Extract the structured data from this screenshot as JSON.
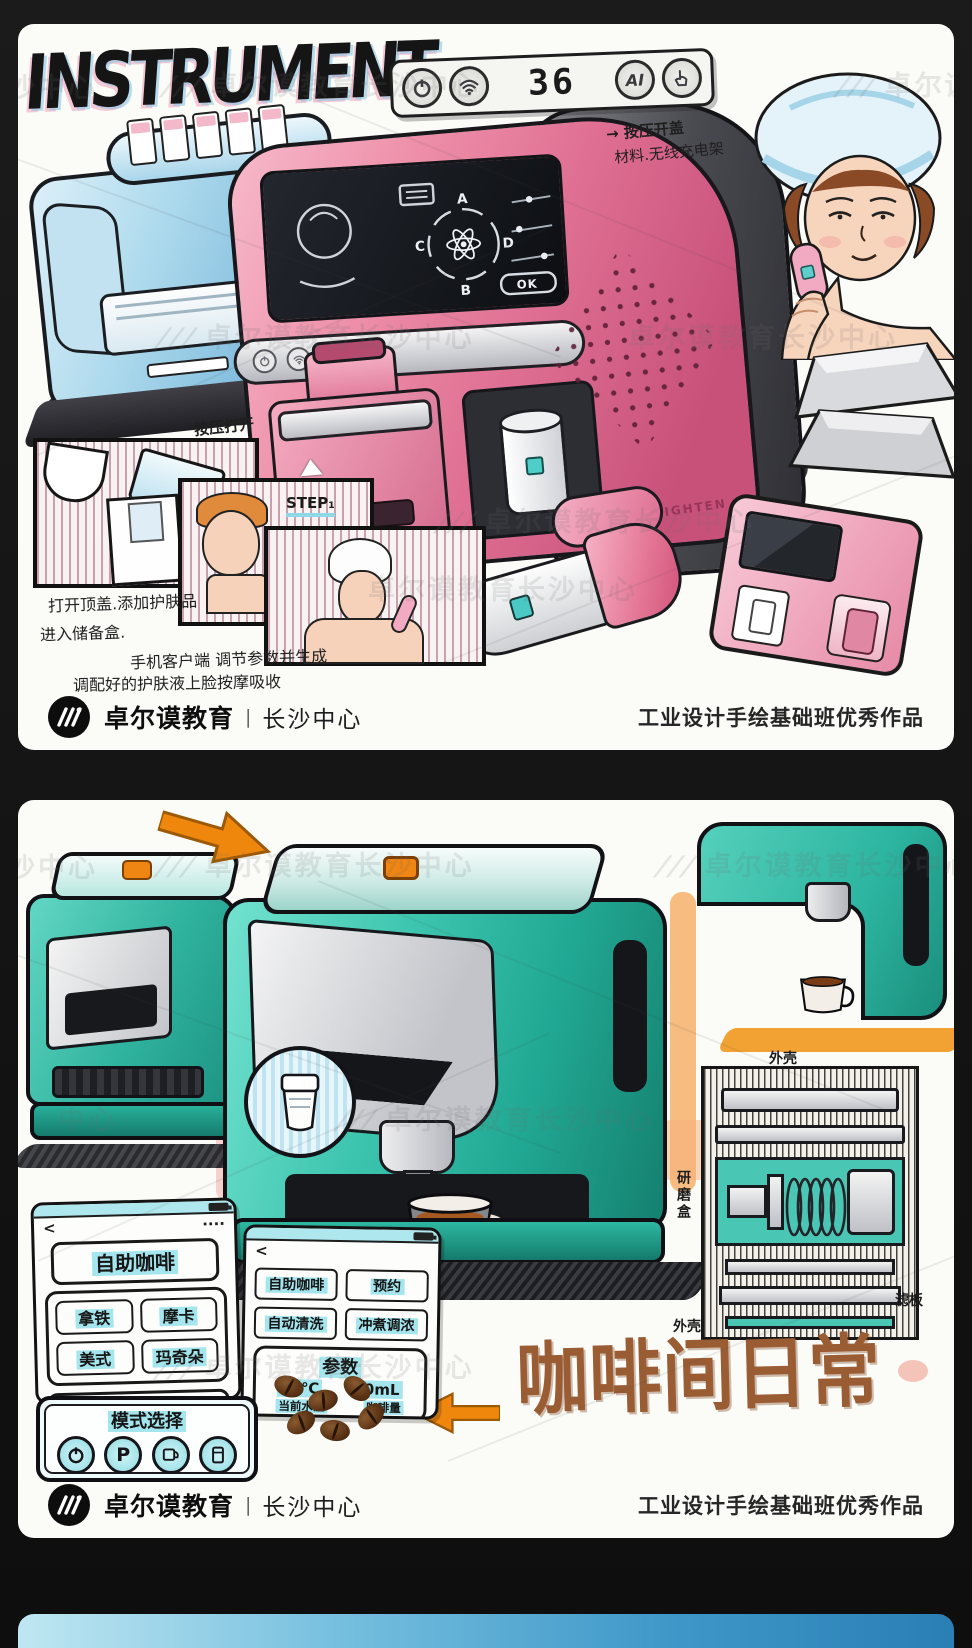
{
  "watermark": {
    "logo": "///",
    "text": "卓尔谟教育长沙中心",
    "partial": "沙中心",
    "partial2": "中心"
  },
  "footer": {
    "brand": "卓尔谟教育",
    "sep": "|",
    "center": "长沙中心",
    "right": "工业设计手绘基础班优秀作品"
  },
  "panel1": {
    "title": "INSTRUMENT",
    "control_bar": {
      "display": "36",
      "ai": "AI"
    },
    "annotations": {
      "arrow": "→",
      "open_lid": "按压开盖",
      "material": "材料.无线充电架",
      "press_open": "按压打开",
      "line1": "打开顶盖.添加护肤品",
      "line2": "进入储备盒.",
      "line3": "手机客户端 调节参数并生成",
      "line4": "调配好的护肤液上脸按摩吸收"
    },
    "steps": [
      "STEP₁",
      "STEP₂",
      "STEP₃"
    ],
    "screen": {
      "a": "A",
      "b": "B",
      "c": "C",
      "d": "D",
      "ok": "OK"
    },
    "device_label": "TIGHTEN"
  },
  "panel2": {
    "phone1": {
      "back": "<",
      "dots": "····",
      "title": "自助咖啡",
      "options": [
        "拿铁",
        "摩卡",
        "美式",
        "玛奇朵"
      ],
      "price": "¥15",
      "confirm": "确认"
    },
    "phone2": {
      "back": "<",
      "buttons": [
        "自助咖啡",
        "预约",
        "自动清洗",
        "冲煮调浓"
      ],
      "params_title": "参数",
      "temp": "40℃",
      "volume": "0mL",
      "temp_label": "当前水温",
      "volume_label": "咖啡量"
    },
    "mode": {
      "title": "模式选择",
      "p_label": "P"
    },
    "exploded": {
      "shell_top": "外壳",
      "grinder": "研磨盒",
      "shell_bottom": "外壳",
      "filter": "滤板"
    },
    "calligraphy": "咖啡间日常"
  }
}
